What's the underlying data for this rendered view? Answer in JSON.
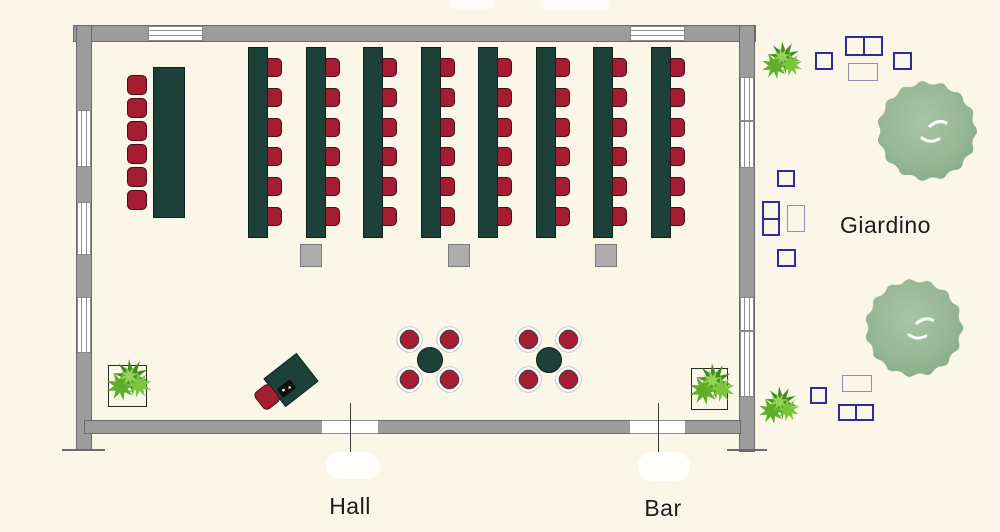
{
  "type": "hotel-meeting-room-floor-plan",
  "labels": {
    "hall": "Hall",
    "bar": "Bar",
    "garden": "Giardino"
  },
  "colors": {
    "bg": "#faf7e8",
    "wall": "#9c9c9c",
    "wall_border": "#6a6a6a",
    "window_line": "#909090",
    "door_line": "#3c3c3c",
    "table": "#1d4138",
    "table_border": "#0d241e",
    "chair": "#a51d31",
    "chair_border": "#43101a",
    "pillar": "#adadad",
    "pillar_border": "#7c7c7c",
    "navy": "#2d2d93",
    "light_outline": "#9090b0",
    "planter_border": "#2a2a2a",
    "device": "#101010",
    "text": "#1b1b1b",
    "foliage_dark": "#3e8f1a",
    "foliage_mid": "#5fae2b",
    "foliage_light": "#7cc43e",
    "foliage_pale": "#93d359",
    "tree_light": "#a9c4a6",
    "tree_mid": "#97b796",
    "tree_dark": "#86ab88"
  },
  "layout_counts": {
    "classroom_tables": 8,
    "chairs_per_classroom_table": 6,
    "head_table_chairs": 6,
    "round_tables": 2,
    "chairs_per_round_table": 4,
    "pillars": 3,
    "doors": 2,
    "windows_top": 2,
    "windows_left": 3,
    "windows_right": 2,
    "indoor_planters": 2,
    "garden_trees": 2,
    "garden_bushes": 2,
    "garden_seating_groups": 3
  }
}
